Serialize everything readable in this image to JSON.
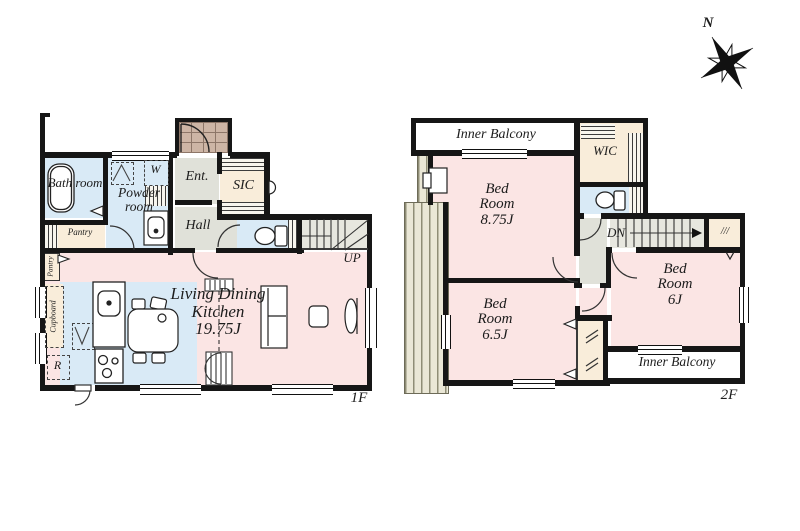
{
  "compass": {
    "north": "N"
  },
  "floor1": {
    "label": "1F",
    "bath": "Bath room",
    "powder": "Powder room",
    "pantry": "Pantry",
    "pantry_side": "Pantry",
    "washer": "W",
    "entrance": "Ent.",
    "sic": "SIC",
    "hall": "Hall",
    "stairs_up": "UP",
    "ldk_name": "Living Dining Kitchen",
    "ldk_size": "19.75J",
    "cupboard": "Cupboard",
    "refrigerator": "R"
  },
  "floor2": {
    "label": "2F",
    "inner_balcony_top": "Inner Balcony",
    "wic": "WIC",
    "bedroom1_name": "Bed Room",
    "bedroom1_size": "8.75J",
    "stairs_down": "DN",
    "hanger_marks": "///",
    "bedroom2_name": "Bed Room",
    "bedroom2_size": "6J",
    "bedroom3_name": "Bed Room",
    "bedroom3_size": "6.5J",
    "inner_balcony_bottom": "Inner Balcony"
  },
  "colors": {
    "room_pink": "#fbe5e4",
    "wet_blue": "#d9eaf6",
    "closet_cream": "#f9edda",
    "hall_gray": "#e0e1d9",
    "stairs_gray": "#e7e7df",
    "porch_tan": "#cdb5a5",
    "wall": "#161616"
  }
}
